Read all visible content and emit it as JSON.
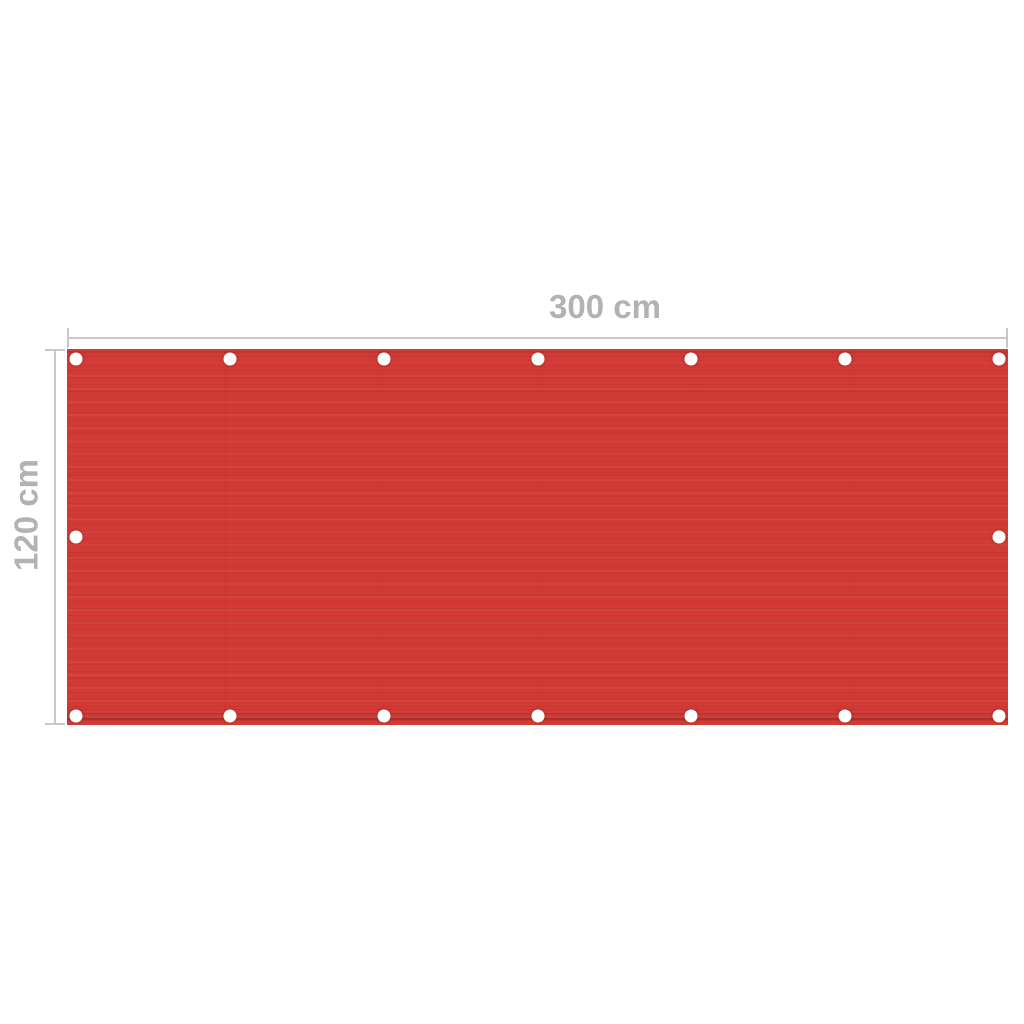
{
  "dimensions": {
    "width_label": "300 cm",
    "height_label": "120 cm"
  },
  "screen": {
    "fabric_color": "#d23b35",
    "grommet_color": "#ffffff",
    "grommets": {
      "top": 7,
      "bottom": 7,
      "left": 1,
      "right": 1
    }
  },
  "style": {
    "background_color": "#ffffff",
    "label_color": "#b2b2b2",
    "line_color": "#c8c8c8"
  }
}
